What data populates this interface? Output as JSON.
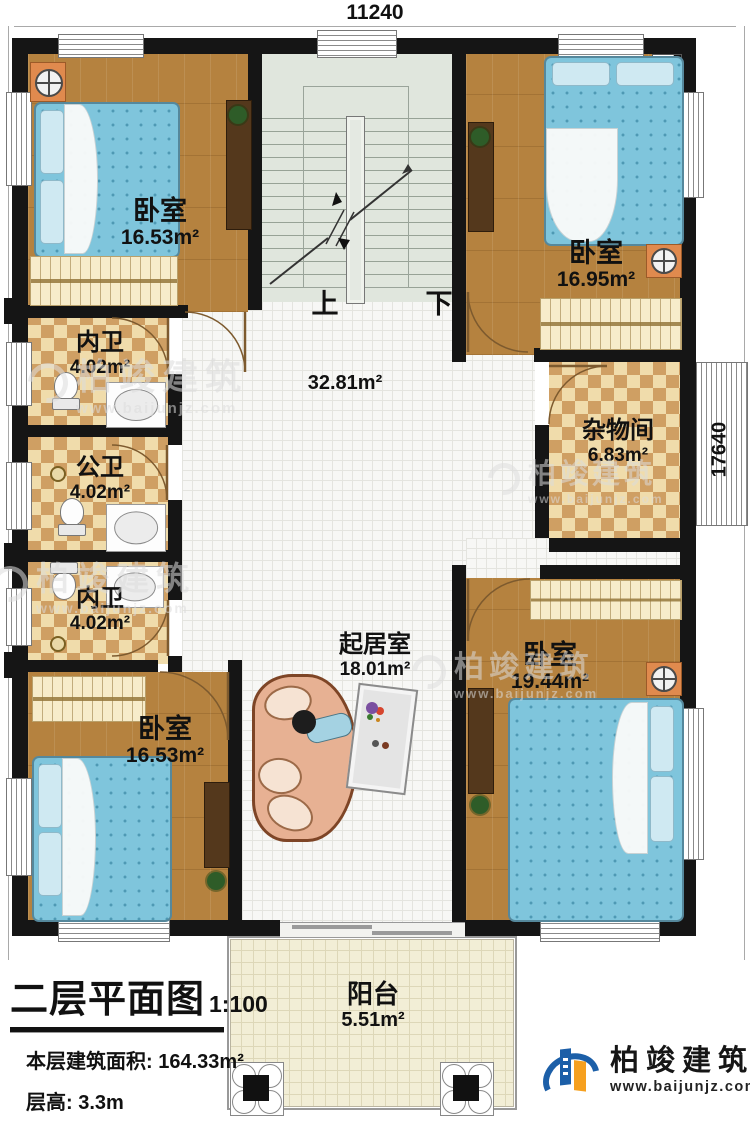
{
  "dimensions": {
    "top_width_mm": "11240",
    "right_height_mm": "17640"
  },
  "rooms": {
    "bedroom_tl": {
      "name": "卧室",
      "area": "16.53m²"
    },
    "bedroom_tr": {
      "name": "卧室",
      "area": "16.95m²"
    },
    "bath_top": {
      "name": "内卫",
      "area": "4.02m²"
    },
    "bath_mid": {
      "name": "公卫",
      "area": "4.02m²"
    },
    "bath_low": {
      "name": "内卫",
      "area": "4.02m²"
    },
    "storage": {
      "name": "杂物间",
      "area": "6.83m²"
    },
    "hall": {
      "area": "32.81m²"
    },
    "living": {
      "name": "起居室",
      "area": "18.01m²"
    },
    "bedroom_bl": {
      "name": "卧室",
      "area": "16.53m²"
    },
    "bedroom_br": {
      "name": "卧室",
      "area": "19.44m²"
    },
    "balcony": {
      "name": "阳台",
      "area": "5.51m²"
    }
  },
  "stairs": {
    "up": "上",
    "down": "下"
  },
  "title_block": {
    "title": "二层平面图",
    "scale": "1:100",
    "area_label": "本层建筑面积:",
    "area_value": "164.33m²",
    "height_label": "层高:",
    "height_value": "3.3m"
  },
  "brand": {
    "name": "柏竣建筑",
    "url": "www.baijunjz.com"
  },
  "watermark": {
    "name": "柏竣建筑",
    "url": "www.baijunjz.com"
  },
  "colors": {
    "wall": "#151515",
    "wood_floor": "#b5823f",
    "checker_light": "#f0dcab",
    "checker_dark": "#cf9f63",
    "tile": "#f7f7f5",
    "stair": "#e0e6dd",
    "balcony": "#f2eed6",
    "bed": "#7fc5dc",
    "nightstand": "#e08a4e",
    "brand_blue": "#1c5fa8",
    "brand_orange": "#f6a01f"
  }
}
